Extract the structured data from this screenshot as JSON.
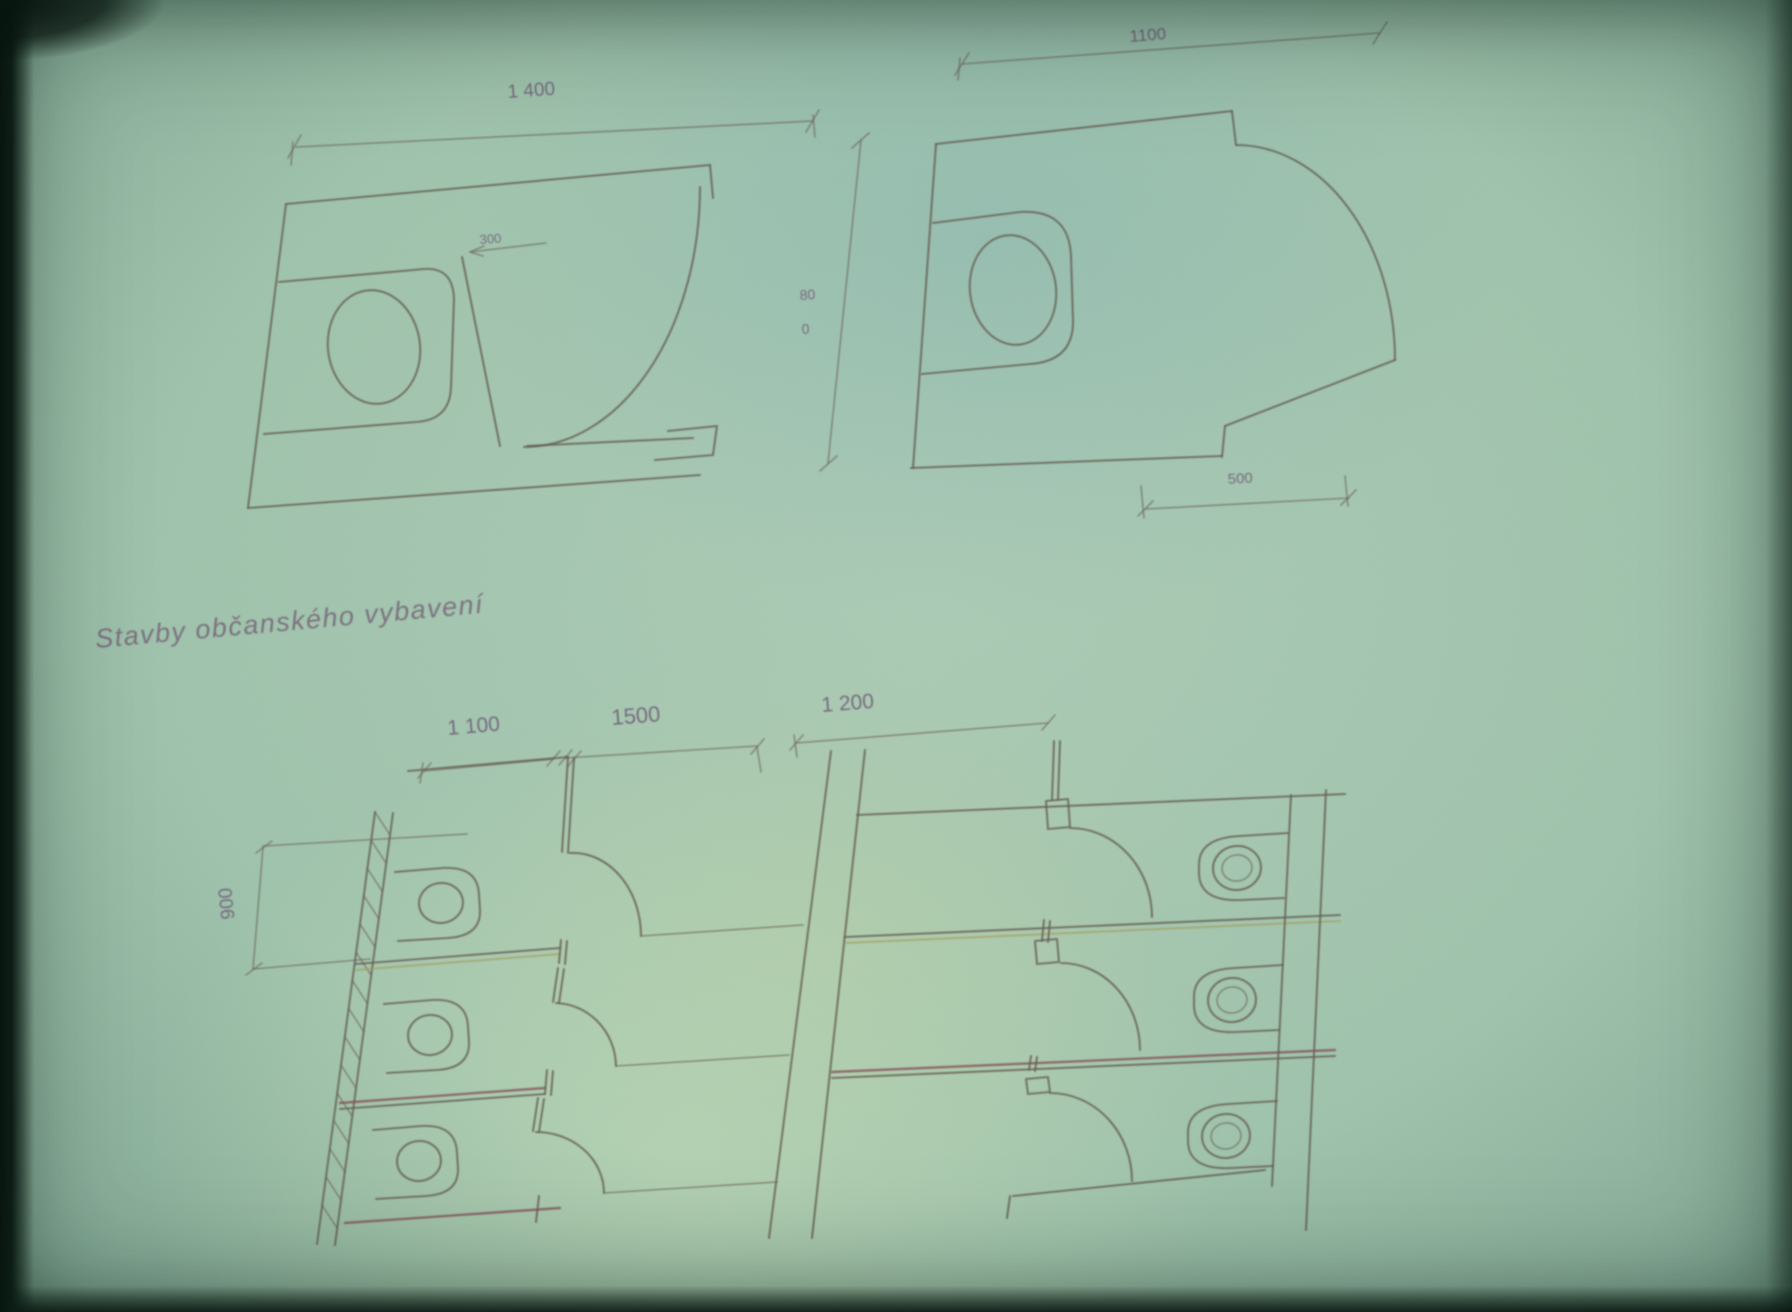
{
  "page": {
    "section_title": "Stavby občanského vybavení"
  },
  "cabin_left": {
    "width_label": "1 400",
    "door_label": "300",
    "depth_label_line1": "80",
    "depth_label_line2": "0"
  },
  "cabin_right": {
    "width_label": "1100",
    "offset_label": "500"
  },
  "stall_rows": {
    "left_depth_label": "1 100",
    "corridor_label": "1500",
    "right_depth_label": "1 200",
    "stall_width_label": "900"
  }
}
